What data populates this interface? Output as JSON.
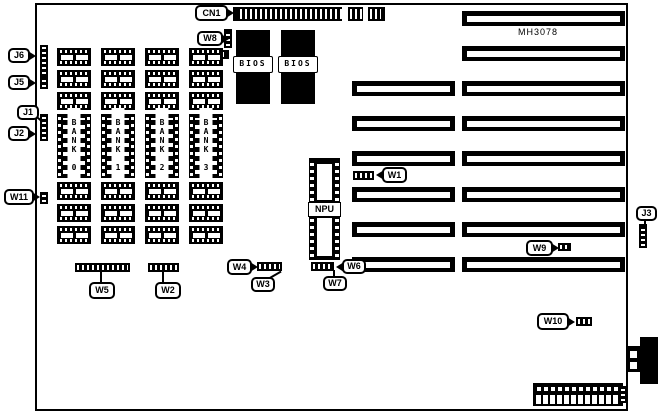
{
  "diagram": {
    "part_number": "MH3078",
    "npu_label": "NPU",
    "bios_chips": [
      "BIOS",
      "BIOS"
    ],
    "banks": [
      "BANK 0",
      "BANK 1",
      "BANK 2",
      "BANK 3"
    ],
    "labels": {
      "cn1": "CN1",
      "w8": "W8",
      "j6": "J6",
      "j5": "J5",
      "j1": "J1",
      "j2": "J2",
      "w11": "W11",
      "w1": "W1",
      "w5": "W5",
      "w2": "W2",
      "w4": "W4",
      "w3": "W3",
      "w6": "W6",
      "w7": "W7",
      "w9": "W9",
      "w10": "W10",
      "j3": "J3"
    },
    "colors": {
      "ink": "#000000",
      "paper": "#ffffff"
    }
  }
}
